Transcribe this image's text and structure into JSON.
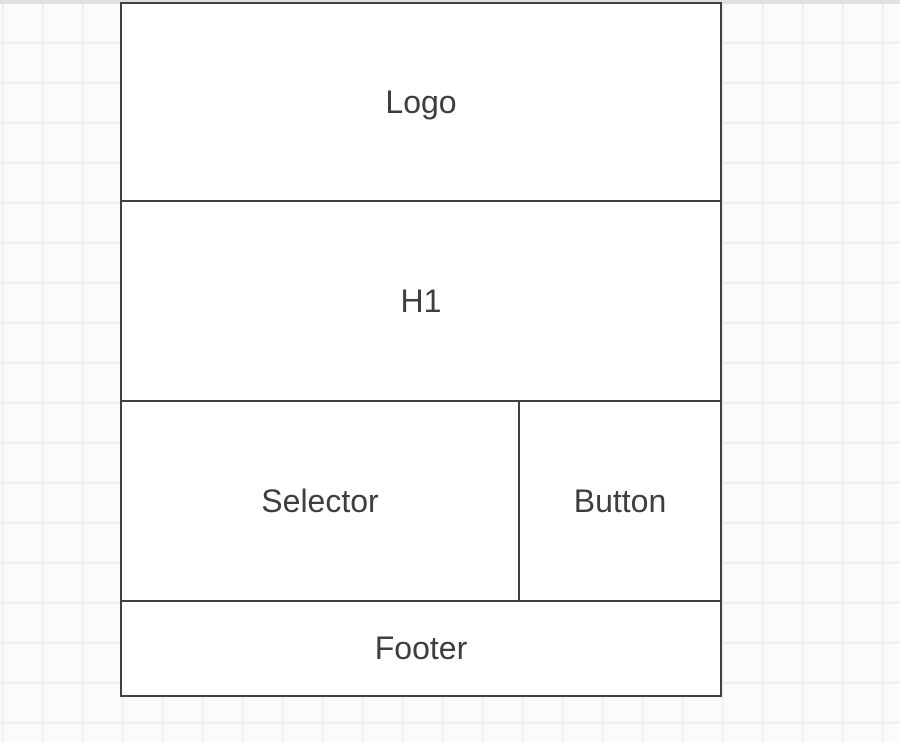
{
  "canvas": {
    "background_color": "#fbfbfb",
    "grid_line_color": "#ececec",
    "grid_size_px": 40,
    "top_edge_color": "#e0e0e0"
  },
  "wireframe": {
    "fill_color": "#ffffff",
    "border_color": "#404040",
    "label_color": "#3e3e3e",
    "sections": {
      "logo": {
        "label": "Logo"
      },
      "h1": {
        "label": "H1"
      },
      "selector": {
        "label": "Selector"
      },
      "button": {
        "label": "Button"
      },
      "footer": {
        "label": "Footer"
      }
    }
  }
}
